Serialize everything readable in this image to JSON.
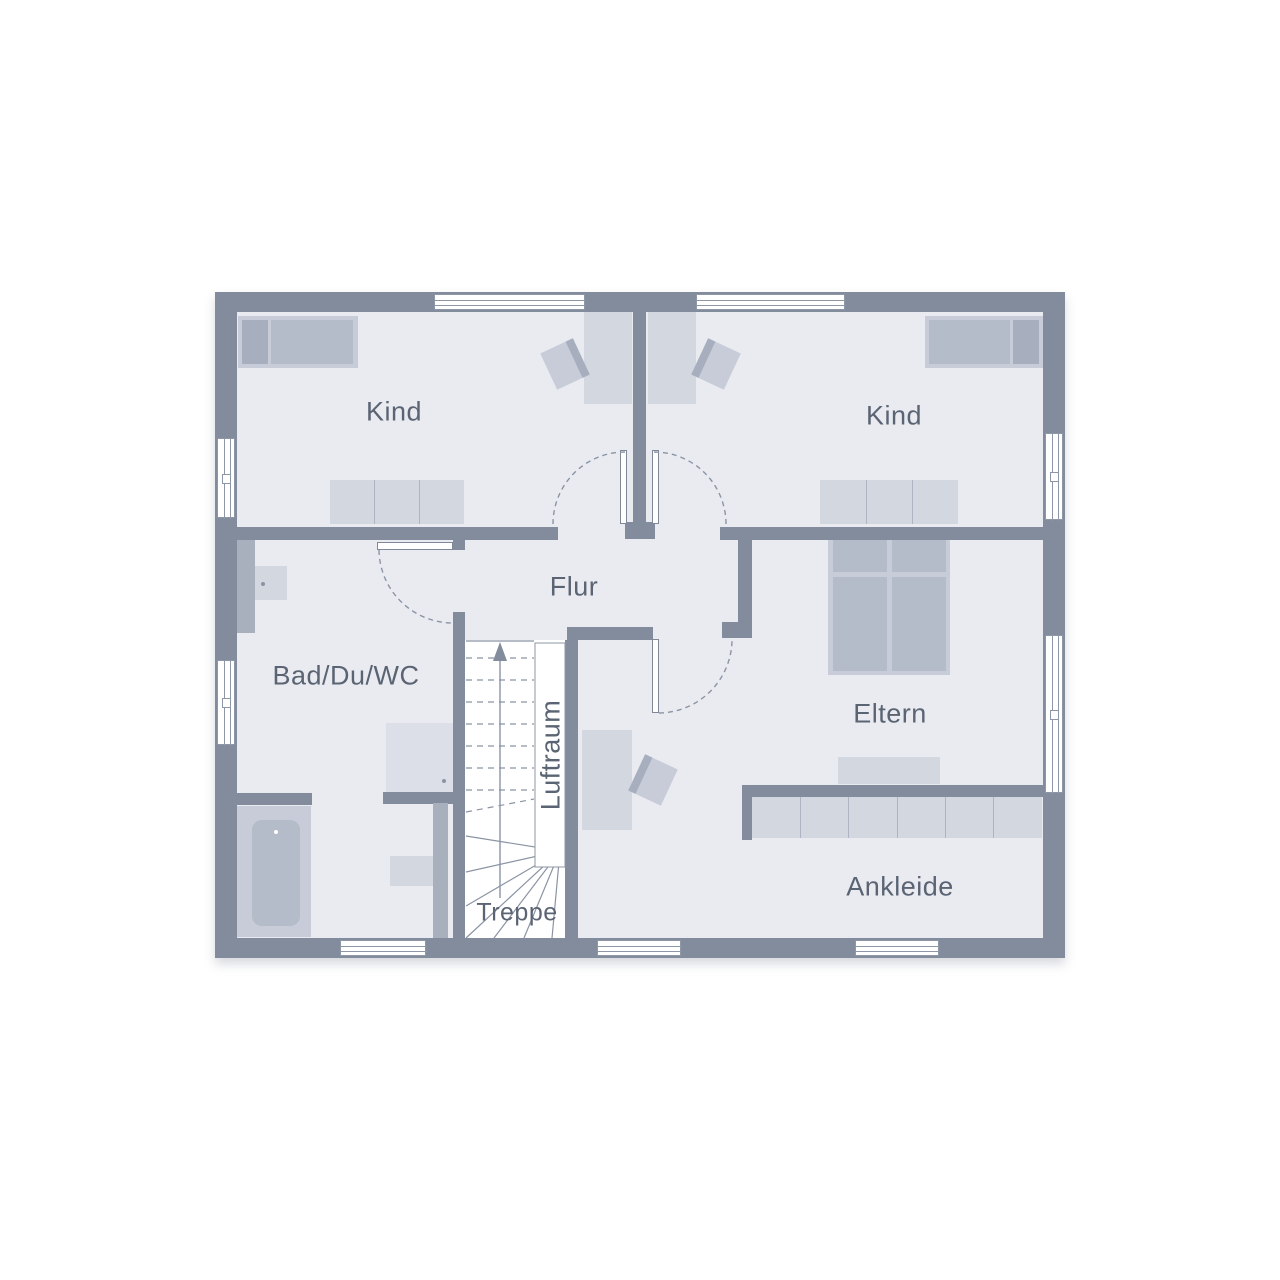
{
  "colors": {
    "wall": "#828c9c",
    "partition": "#a9b0bd",
    "floor": "#e9ebf1",
    "stair_floor": "#ffffff",
    "line": "#8b94a4",
    "frame": "#8e97a6",
    "leaf_border": "#7f8898",
    "text": "#5b6473",
    "furn_light": "#d3d7e0",
    "furn_light2": "#c7ccd8",
    "furn_med": "#b5bcc9",
    "furn_dark": "#a7aebd",
    "shower": "#dcdfe7",
    "divider": "#aeb4c1",
    "white": "#ffffff",
    "shadow": "rgba(110,120,138,0.28)"
  },
  "rooms": {
    "kind_left": {
      "label": "Kind",
      "x": 394,
      "y": 412
    },
    "kind_right": {
      "label": "Kind",
      "x": 894,
      "y": 416
    },
    "flur": {
      "label": "Flur",
      "x": 574,
      "y": 587
    },
    "bad": {
      "label": "Bad/Du/WC",
      "x": 346,
      "y": 676
    },
    "eltern": {
      "label": "Eltern",
      "x": 890,
      "y": 714
    },
    "ankleide": {
      "label": "Ankleide",
      "x": 900,
      "y": 887
    },
    "treppe": {
      "label": "Treppe",
      "x": 517,
      "y": 913,
      "small": true
    },
    "luftraum": {
      "label": "Luftraum",
      "x": 551,
      "y": 755,
      "vertical": true
    }
  },
  "plan": {
    "outline": {
      "x": 215,
      "y": 292,
      "w": 850,
      "h": 666
    },
    "floor": {
      "x": 237,
      "y": 312,
      "w": 806,
      "h": 626
    },
    "stairs": {
      "area": {
        "x": 465,
        "y": 640,
        "w": 100,
        "h": 298
      },
      "top_edge": {
        "x1": 466,
        "y1": 641,
        "x2": 534,
        "y2": 641
      },
      "tread_x": [
        466,
        534
      ],
      "treads": [
        658,
        680,
        702,
        724,
        746,
        768,
        790
      ],
      "sloped_tread": {
        "x1": 466,
        "y1": 812,
        "x2": 534,
        "y2": 799
      },
      "fan_hub": {
        "x": 560,
        "y": 851
      },
      "fan_ends": [
        [
          466,
          836
        ],
        [
          466,
          872
        ],
        [
          466,
          906
        ],
        [
          466,
          938
        ],
        [
          494,
          938
        ],
        [
          524,
          938
        ],
        [
          552,
          938
        ]
      ],
      "luftraum_rect": {
        "x": 535,
        "y": 643,
        "w": 30,
        "h": 224
      },
      "arrow": {
        "x": 500,
        "y_tail": 898,
        "y_head": 656,
        "head": "500,642 493,661 507,661"
      }
    },
    "walls": [
      {
        "name": "exterior-wall-top",
        "x": 215,
        "y": 292,
        "w": 850,
        "h": 20,
        "shade": "dark"
      },
      {
        "name": "exterior-wall-left",
        "x": 215,
        "y": 292,
        "w": 22,
        "h": 666,
        "shade": "dark"
      },
      {
        "name": "exterior-wall-right",
        "x": 1043,
        "y": 292,
        "w": 22,
        "h": 666,
        "shade": "dark"
      },
      {
        "name": "exterior-wall-bottom",
        "x": 215,
        "y": 938,
        "w": 850,
        "h": 20,
        "shade": "dark"
      },
      {
        "name": "wall-kids-divider",
        "x": 633,
        "y": 312,
        "w": 13,
        "h": 210,
        "shade": "dark"
      },
      {
        "name": "wall-kids-divider-cap",
        "x": 625,
        "y": 522,
        "w": 30,
        "h": 17,
        "shade": "dark"
      },
      {
        "name": "wall-kindleft-flur",
        "x": 237,
        "y": 527,
        "w": 321,
        "h": 13,
        "shade": "dark"
      },
      {
        "name": "wall-kindright-eltern",
        "x": 720,
        "y": 527,
        "w": 323,
        "h": 13,
        "shade": "dark"
      },
      {
        "name": "wall-flur-eltern",
        "x": 738,
        "y": 540,
        "w": 14,
        "h": 83,
        "shade": "dark"
      },
      {
        "name": "wall-flur-eltern-cap",
        "x": 722,
        "y": 622,
        "w": 30,
        "h": 16,
        "shade": "dark"
      },
      {
        "name": "wall-stair-top",
        "x": 567,
        "y": 627,
        "w": 86,
        "h": 13,
        "shade": "dark"
      },
      {
        "name": "wall-bad-door-jamb",
        "x": 453,
        "y": 540,
        "w": 12,
        "h": 10,
        "shade": "dark"
      },
      {
        "name": "wall-bad-right",
        "x": 453,
        "y": 612,
        "w": 12,
        "h": 326,
        "shade": "dark"
      },
      {
        "name": "wall-luftraum-right",
        "x": 565,
        "y": 640,
        "w": 13,
        "h": 298,
        "shade": "dark"
      },
      {
        "name": "wall-tub-nook",
        "x": 236,
        "y": 793,
        "w": 76,
        "h": 12,
        "shade": "dark"
      },
      {
        "name": "wall-shower-nook",
        "x": 383,
        "y": 792,
        "w": 72,
        "h": 12,
        "shade": "dark"
      },
      {
        "name": "wall-eltern-ankleide",
        "x": 742,
        "y": 785,
        "w": 301,
        "h": 12,
        "shade": "dark"
      },
      {
        "name": "wall-ankleide-stub",
        "x": 742,
        "y": 785,
        "w": 10,
        "h": 55,
        "shade": "dark"
      },
      {
        "name": "partition-bad-install",
        "x": 237,
        "y": 540,
        "w": 18,
        "h": 93,
        "shade": "medium"
      },
      {
        "name": "partition-wc",
        "x": 433,
        "y": 803,
        "w": 15,
        "h": 135,
        "shade": "medium"
      }
    ],
    "windows": [
      {
        "name": "window-top-kindleft",
        "x": 434,
        "y": 294,
        "w": 151,
        "h": 16,
        "orient": "h"
      },
      {
        "name": "window-top-kindright",
        "x": 696,
        "y": 294,
        "w": 149,
        "h": 16,
        "orient": "h"
      },
      {
        "name": "window-left-kind",
        "x": 217,
        "y": 438,
        "w": 18,
        "h": 80,
        "orient": "v"
      },
      {
        "name": "window-left-bad",
        "x": 217,
        "y": 660,
        "w": 18,
        "h": 85,
        "orient": "v"
      },
      {
        "name": "window-right-kind",
        "x": 1045,
        "y": 433,
        "w": 18,
        "h": 87,
        "orient": "v"
      },
      {
        "name": "window-right-eltern",
        "x": 1045,
        "y": 635,
        "w": 18,
        "h": 158,
        "orient": "v"
      },
      {
        "name": "window-bottom-bad",
        "x": 340,
        "y": 940,
        "w": 86,
        "h": 16,
        "orient": "h"
      },
      {
        "name": "window-bottom-eltern",
        "x": 597,
        "y": 940,
        "w": 84,
        "h": 16,
        "orient": "h"
      },
      {
        "name": "window-bottom-ankleide",
        "x": 855,
        "y": 940,
        "w": 84,
        "h": 16,
        "orient": "h"
      }
    ],
    "door_leaves": [
      {
        "name": "door-leaf-kind-left",
        "x": 620,
        "y": 450,
        "w": 7,
        "h": 74
      },
      {
        "name": "door-leaf-kind-right",
        "x": 652,
        "y": 450,
        "w": 7,
        "h": 74
      },
      {
        "name": "door-leaf-bad",
        "x": 377,
        "y": 542,
        "w": 76,
        "h": 8
      },
      {
        "name": "door-leaf-eltern",
        "x": 652,
        "y": 639,
        "w": 7,
        "h": 74
      }
    ],
    "door_arcs": [
      {
        "name": "door-arc-kind-left",
        "path": "M 553 524 A 72 72 0 0 1 625 452"
      },
      {
        "name": "door-arc-kind-right",
        "path": "M 654 452 A 72 72 0 0 1 726 524"
      },
      {
        "name": "door-arc-bad",
        "path": "M 379 550 A 74 74 0 0 0 453 623"
      },
      {
        "name": "door-arc-eltern",
        "path": "M 659 713 A 74 74 0 0 0 732 641"
      }
    ],
    "furniture": [
      {
        "name": "kindleft-bed-frame",
        "x": 238,
        "y": 316,
        "w": 120,
        "h": 52,
        "fill": "furn_light2"
      },
      {
        "name": "kindleft-bed-pillow",
        "x": 242,
        "y": 320,
        "w": 26,
        "h": 44,
        "fill": "furn_dark"
      },
      {
        "name": "kindleft-bed-mattress",
        "x": 271,
        "y": 320,
        "w": 82,
        "h": 44,
        "fill": "furn_med"
      },
      {
        "name": "kindleft-desk",
        "x": 584,
        "y": 312,
        "w": 48,
        "h": 92,
        "fill": "furn_light"
      },
      {
        "name": "kindleft-dresser",
        "x": 330,
        "y": 480,
        "w": 134,
        "h": 44,
        "fill": "furn_light",
        "segments": 3
      },
      {
        "name": "kindright-bed-frame",
        "x": 925,
        "y": 316,
        "w": 118,
        "h": 52,
        "fill": "furn_light2"
      },
      {
        "name": "kindright-bed-mattress",
        "x": 929,
        "y": 320,
        "w": 81,
        "h": 44,
        "fill": "furn_med"
      },
      {
        "name": "kindright-bed-pillow",
        "x": 1013,
        "y": 320,
        "w": 26,
        "h": 44,
        "fill": "furn_dark"
      },
      {
        "name": "kindright-desk",
        "x": 648,
        "y": 312,
        "w": 48,
        "h": 92,
        "fill": "furn_light"
      },
      {
        "name": "kindright-dresser",
        "x": 820,
        "y": 480,
        "w": 138,
        "h": 44,
        "fill": "furn_light",
        "segments": 3
      },
      {
        "name": "eltern-bed-frame",
        "x": 828,
        "y": 535,
        "w": 122,
        "h": 140,
        "fill": "furn_light2"
      },
      {
        "name": "eltern-bed-pillow-l",
        "x": 833,
        "y": 539,
        "w": 54,
        "h": 33,
        "fill": "furn_med"
      },
      {
        "name": "eltern-bed-pillow-r",
        "x": 892,
        "y": 539,
        "w": 54,
        "h": 33,
        "fill": "furn_med"
      },
      {
        "name": "eltern-bed-mattress-l",
        "x": 833,
        "y": 577,
        "w": 54,
        "h": 94,
        "fill": "furn_med"
      },
      {
        "name": "eltern-bed-mattress-r",
        "x": 892,
        "y": 577,
        "w": 54,
        "h": 94,
        "fill": "furn_med"
      },
      {
        "name": "eltern-dresser",
        "x": 838,
        "y": 757,
        "w": 102,
        "h": 27,
        "fill": "furn_light"
      },
      {
        "name": "eltern-desk",
        "x": 582,
        "y": 730,
        "w": 50,
        "h": 100,
        "fill": "furn_light"
      },
      {
        "name": "ankleide-wardrobe",
        "x": 752,
        "y": 797,
        "w": 290,
        "h": 41,
        "fill": "furn_light",
        "segments": 6
      },
      {
        "name": "bad-sink",
        "x": 255,
        "y": 566,
        "w": 32,
        "h": 34,
        "fill": "furn_light"
      },
      {
        "name": "bad-shower",
        "x": 386,
        "y": 723,
        "w": 67,
        "h": 69,
        "fill": "shower"
      },
      {
        "name": "bad-tub-outer",
        "x": 236,
        "y": 806,
        "w": 75,
        "h": 131,
        "fill": "furn_light2"
      },
      {
        "name": "bad-tub-inner",
        "x": 252,
        "y": 820,
        "w": 48,
        "h": 106,
        "fill": "furn_med",
        "radius": 10
      },
      {
        "name": "bad-wc",
        "x": 390,
        "y": 856,
        "w": 43,
        "h": 30,
        "fill": "furn_light"
      }
    ],
    "chairs": [
      {
        "name": "kindleft-desk-chair",
        "x": 547,
        "y": 344,
        "w": 36,
        "h": 40,
        "rotate": -25,
        "back": "e"
      },
      {
        "name": "kindright-desk-chair",
        "x": 698,
        "y": 344,
        "w": 36,
        "h": 40,
        "rotate": 25,
        "back": "w"
      },
      {
        "name": "eltern-desk-chair",
        "x": 635,
        "y": 760,
        "w": 36,
        "h": 40,
        "rotate": 25,
        "back": "w"
      }
    ],
    "dots": [
      {
        "name": "bad-sink-faucet-dot",
        "x": 263,
        "y": 584,
        "color": "line",
        "r": 2
      },
      {
        "name": "bad-shower-drain-dot",
        "x": 444,
        "y": 781,
        "color": "line",
        "r": 2
      },
      {
        "name": "bad-tub-drain-dot",
        "x": 276,
        "y": 832,
        "color": "white",
        "r": 2
      }
    ]
  }
}
